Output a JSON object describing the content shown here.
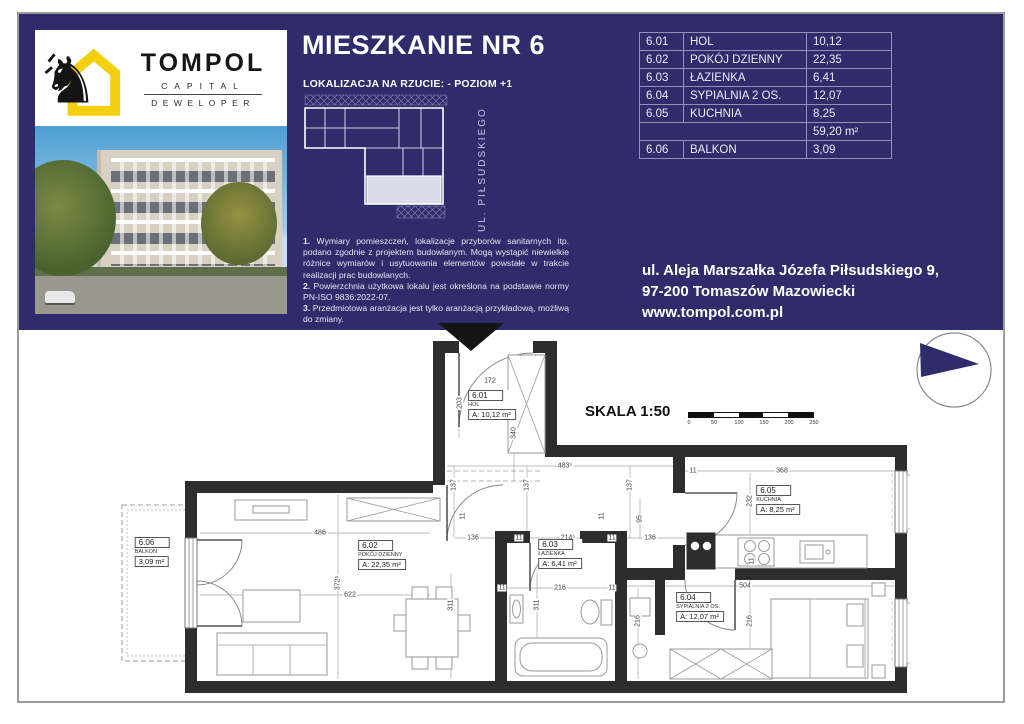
{
  "colors": {
    "navy": "#2e2c6a",
    "yellow": "#f3cf0e",
    "wall": "#2d2d2d"
  },
  "brand": {
    "name": "TOMPOL",
    "sub1": "CAPITAL",
    "sub2": "DEWELOPER"
  },
  "header": {
    "title": "MIESZKANIE NR 6",
    "location_line": "LOKALIZACJA NA RZUCIE: - POZIOM +1",
    "street_label": "UL. PIŁSUDSKIEGO",
    "notes": [
      {
        "num": "1.",
        "text": " Wymiary pomieszczeń, lokalizacje przyborów sanitarnych itp. podano zgodnie z projektem budowlanym. Mogą wystąpić niewielkie różnice wymiarów i usytuowania elementów powstałe w trakcie realizacji prac budowlanych."
      },
      {
        "num": "2.",
        "text": " Powierzchnia użytkowa lokalu jest określona na podstawie normy PN-ISO 9836:2022-07."
      },
      {
        "num": "3.",
        "text": " Przedmiotowa aranżacja jest tylko aranżacją przykładową, możliwą do zmiany."
      }
    ],
    "table": {
      "rows": [
        [
          "6.01",
          "HOL",
          "10,12"
        ],
        [
          "6.02",
          "POKÓJ DZIENNY",
          "22,35"
        ],
        [
          "6.03",
          "ŁAZIENKA",
          "6,41"
        ],
        [
          "6.04",
          "SYPIALNIA 2 OS.",
          "12,07"
        ],
        [
          "6.05",
          "KUCHNIA",
          "8,25"
        ],
        [
          "",
          "",
          "59,20 m²"
        ],
        [
          "6.06",
          "BALKON",
          "3,09"
        ]
      ]
    },
    "address": [
      "ul. Aleja Marszałka Józefa Piłsudskiego 9,",
      "97-200 Tomaszów Mazowiecki",
      "www.tompol.com.pl"
    ]
  },
  "plan": {
    "scale_label": "SKALA 1:50",
    "scale_ticks": [
      "0",
      "50",
      "100",
      "150",
      "200",
      "250"
    ],
    "rooms": [
      {
        "id": "6.01",
        "name": "HOL",
        "area": "A: 10,12 m²",
        "x": 382,
        "y": 72
      },
      {
        "id": "6.02",
        "name": "POKÓJ DZIENNY",
        "area": "A: 22,35 m²",
        "x": 272,
        "y": 222
      },
      {
        "id": "6.03",
        "name": "ŁAZIENKA",
        "area": "A: 6,41 m²",
        "x": 450,
        "y": 221
      },
      {
        "id": "6.04",
        "name": "SYPIALNIA 2 OS.",
        "area": "A: 12,07 m²",
        "x": 590,
        "y": 274
      },
      {
        "id": "6.05",
        "name": "KUCHNIA",
        "area": "A: 8,25 m²",
        "x": 668,
        "y": 167
      },
      {
        "id": "6.06",
        "name": "BALKON",
        "area": "3,09 m²",
        "x": 42,
        "y": 219
      }
    ],
    "dimensions": [
      {
        "t": "172",
        "x": 380,
        "y": 48
      },
      {
        "t": "203",
        "x": 350,
        "y": 70,
        "v": 1
      },
      {
        "t": "340",
        "x": 404,
        "y": 100,
        "v": 1
      },
      {
        "t": "483⁵",
        "x": 455,
        "y": 133
      },
      {
        "t": "137",
        "x": 344,
        "y": 152,
        "v": 1
      },
      {
        "t": "137",
        "x": 417,
        "y": 152,
        "v": 1
      },
      {
        "t": "137",
        "x": 520,
        "y": 152,
        "v": 1
      },
      {
        "t": "11",
        "x": 353,
        "y": 183,
        "v": 1
      },
      {
        "t": "11",
        "x": 492,
        "y": 183,
        "v": 1
      },
      {
        "t": "136",
        "x": 363,
        "y": 205
      },
      {
        "t": "11",
        "x": 409,
        "y": 205
      },
      {
        "t": "214⁵",
        "x": 458,
        "y": 205
      },
      {
        "t": "11",
        "x": 502,
        "y": 205
      },
      {
        "t": "136",
        "x": 540,
        "y": 205
      },
      {
        "t": "95",
        "x": 530,
        "y": 186,
        "v": 1
      },
      {
        "t": "11",
        "x": 583,
        "y": 138
      },
      {
        "t": "368",
        "x": 672,
        "y": 138
      },
      {
        "t": "232",
        "x": 640,
        "y": 168,
        "v": 1
      },
      {
        "t": "11",
        "x": 642,
        "y": 228,
        "v": 1
      },
      {
        "t": "486",
        "x": 210,
        "y": 200
      },
      {
        "t": "372⁵",
        "x": 228,
        "y": 250,
        "v": 1
      },
      {
        "t": "622",
        "x": 240,
        "y": 262
      },
      {
        "t": "311",
        "x": 341,
        "y": 272,
        "v": 1
      },
      {
        "t": "311",
        "x": 427,
        "y": 272,
        "v": 1
      },
      {
        "t": "11",
        "x": 392,
        "y": 255
      },
      {
        "t": "216",
        "x": 450,
        "y": 255
      },
      {
        "t": "11",
        "x": 502,
        "y": 255
      },
      {
        "t": "504",
        "x": 635,
        "y": 253
      },
      {
        "t": "216",
        "x": 528,
        "y": 288,
        "v": 1
      },
      {
        "t": "216",
        "x": 640,
        "y": 288,
        "v": 1
      }
    ]
  }
}
